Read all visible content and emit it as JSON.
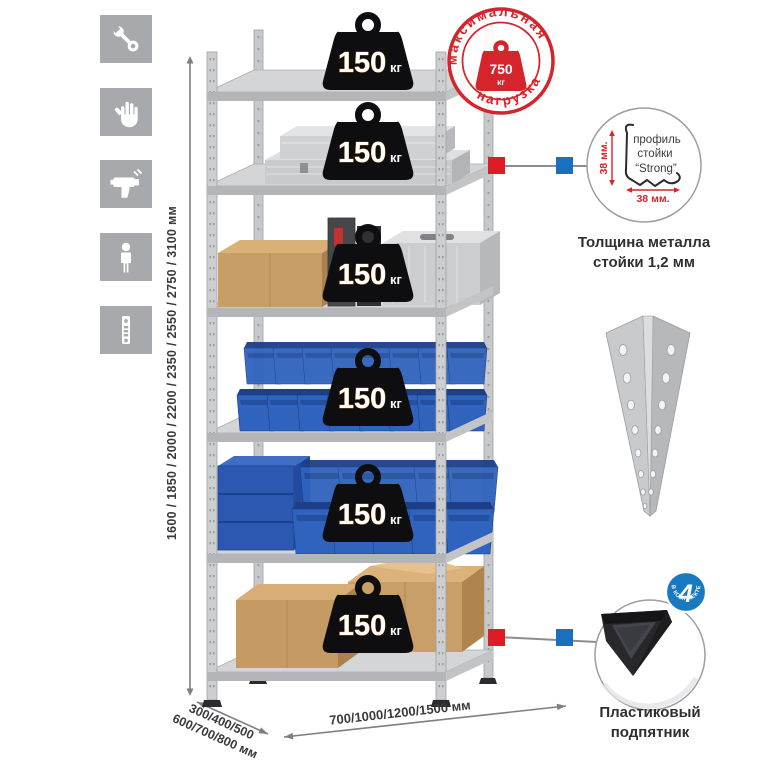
{
  "sidebar": {
    "icons": [
      {
        "name": "wrench-icon"
      },
      {
        "name": "gloves-icon"
      },
      {
        "name": "drill-icon"
      },
      {
        "name": "person-icon"
      },
      {
        "name": "perforated-post-icon"
      }
    ]
  },
  "dimensions": {
    "height": "1600 / 1850 / 2000 / 2200 / 2350 / 2550 / 2750 / 3100 мм",
    "depth_line1": "300/400/500",
    "depth_line2": "600/700/800 мм",
    "width": "700/1000/1200/1500 мм"
  },
  "rack": {
    "shelf_count": 6,
    "badges": [
      {
        "value": "150",
        "unit": "кг"
      },
      {
        "value": "150",
        "unit": "кг"
      },
      {
        "value": "150",
        "unit": "кг"
      },
      {
        "value": "150",
        "unit": "кг"
      },
      {
        "value": "150",
        "unit": "кг"
      },
      {
        "value": "150",
        "unit": "кг"
      }
    ]
  },
  "max_load_stamp": {
    "arc_top": "максимальная",
    "arc_bottom": "нагрузка",
    "value": "750",
    "unit": "кг"
  },
  "profile_detail": {
    "label_line1": "профиль",
    "label_line2": "стойки",
    "label_line3": "“Strong”",
    "dim_vertical": "38 мм.",
    "dim_horizontal": "38 мм.",
    "caption_line1": "Толщина металла",
    "caption_line2": "стойки 1,2 мм"
  },
  "foot_detail": {
    "badge_value": "4",
    "badge_arc": "в комплекте",
    "caption_line1": "Пластиковый",
    "caption_line2": "подпятник"
  },
  "colors": {
    "accent_red": "#d5242c",
    "marker_red": "#e01b26",
    "marker_blue": "#1b6fc0",
    "bin_blue": "#2f63bd",
    "badge_black": "#0e0e10",
    "metal_gray": "#d4d5d7",
    "tile_gray": "#a7a9ac",
    "cardboard": "#c59b63"
  }
}
